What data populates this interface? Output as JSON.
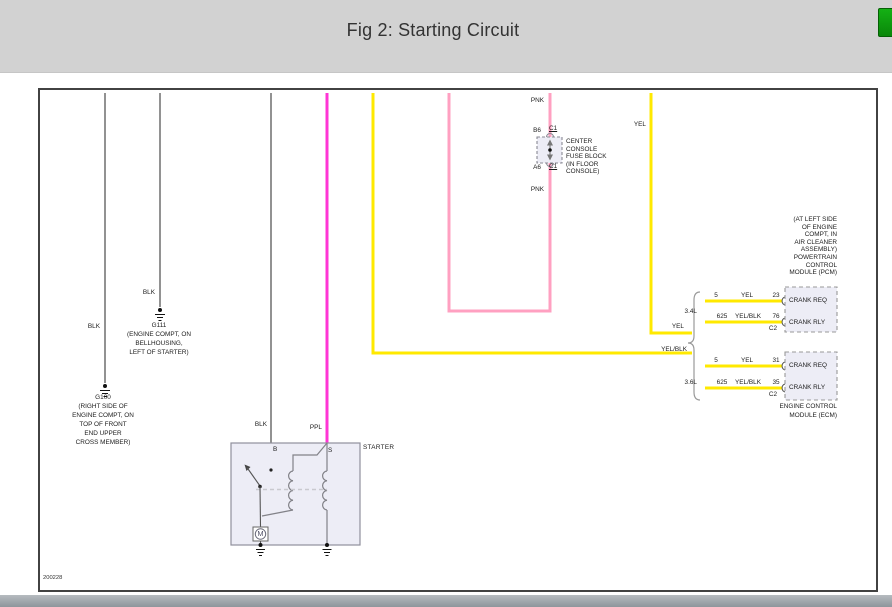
{
  "header": {
    "title": "Fig 2: Starting Circuit"
  },
  "colors": {
    "yel": "#ffe900",
    "pnk": "#ffa0c1",
    "ppl": "#ff35d5",
    "blk": "#4a4a4a",
    "gry": "#8a8a8a",
    "header_bg": "#d2d2d2",
    "green_button": "#0f9c0f"
  },
  "diagram": {
    "doc_number": "200228",
    "wires": {
      "pnk_top": "PNK",
      "pnk_bottom": "PNK",
      "yel_top": "YEL",
      "yel_mid": "YEL",
      "yelblk_mid": "YEL/BLK",
      "blk_g100": "BLK",
      "blk_g111": "BLK",
      "blk_starter": "BLK",
      "ppl": "PPL"
    },
    "fuse_block": {
      "pin_top": "B6",
      "conn_top": "C1",
      "pin_bottom": "A6",
      "conn_bottom": "C1",
      "label_lines": [
        "CENTER",
        "CONSOLE",
        "FUSE BLOCK",
        "(IN FLOOR",
        "CONSOLE)"
      ]
    },
    "grounds": {
      "g111": {
        "id": "G111",
        "location_lines": [
          "(ENGINE COMPT, ON",
          "BELLHOUSING,",
          "LEFT OF STARTER)"
        ]
      },
      "g100": {
        "id": "G100",
        "location_lines": [
          "(RIGHT SIDE OF",
          "ENGINE COMPT, ON",
          "TOP OF FRONT",
          "END UPPER",
          "CROSS MEMBER)"
        ]
      }
    },
    "starter": {
      "label": "STARTER",
      "terminal_b": "B",
      "terminal_s": "S",
      "motor": "M"
    },
    "split": {
      "top_engine": "3.4L",
      "bottom_engine": "3.6L"
    },
    "pcm": {
      "note_lines": [
        "(AT LEFT SIDE",
        "OF ENGINE",
        "COMPT, IN",
        "AIR CLEANER",
        "ASSEMBLY)",
        "POWERTRAIN",
        "CONTROL",
        "MODULE (PCM)"
      ],
      "rows": [
        {
          "circuit": "5",
          "color": "YEL",
          "pin": "23",
          "signal": "CRANK REQ"
        },
        {
          "circuit": "625",
          "color": "YEL/BLK",
          "pin": "76",
          "connector": "C2",
          "signal": "CRANK RLY"
        }
      ]
    },
    "ecm": {
      "name_lines": [
        "ENGINE CONTROL",
        "MODULE (ECM)"
      ],
      "rows": [
        {
          "circuit": "5",
          "color": "YEL",
          "pin": "31",
          "signal": "CRANK REQ"
        },
        {
          "circuit": "625",
          "color": "YEL/BLK",
          "pin": "35",
          "connector": "C2",
          "signal": "CRANK RLY"
        }
      ]
    }
  }
}
